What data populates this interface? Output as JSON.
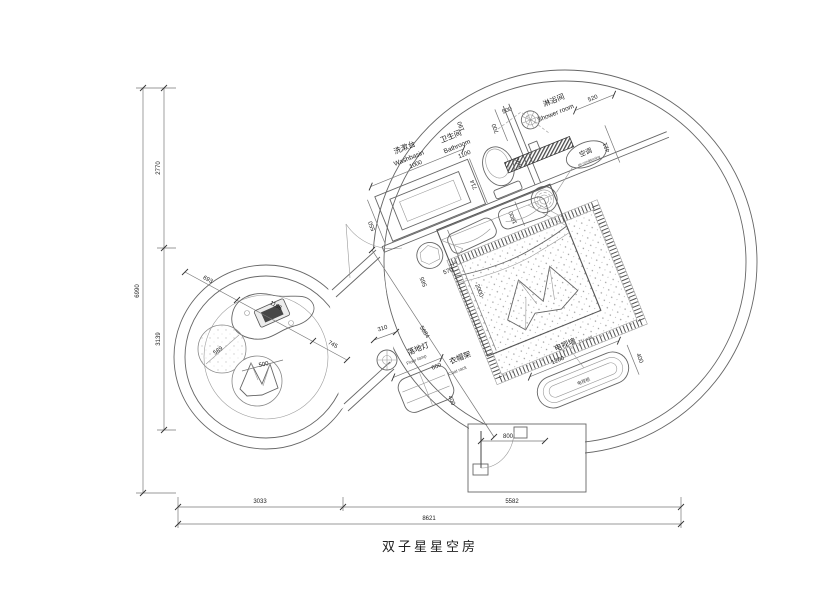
{
  "title": "双子星星空房",
  "dims": {
    "height_total": "6990",
    "height_top": "2770",
    "height_mid": "3139",
    "width_left": "3033",
    "width_right": "5582",
    "width_total": "8621",
    "washbasin": "1000",
    "washbasin_depth": "550",
    "bathroom": "1100",
    "d190": "190",
    "d700": "700",
    "d500": "500",
    "d590": "590",
    "d714": "714",
    "d1800": "1800",
    "d520": "520",
    "d421": "421",
    "d565": "565",
    "d570": "570",
    "d2000": "2000",
    "d5684": "5684",
    "d310": "310",
    "d660": "660",
    "d400_coat": "400",
    "d1200": "1200",
    "d400_tv": "400",
    "d800": "800",
    "d693": "693",
    "d1166": "1166",
    "d745": "745",
    "d589": "589",
    "d500_stool": "500"
  },
  "labels": {
    "washbasin_cn": "洗漱台",
    "washbasin_en": "Washbasin",
    "bathroom_cn": "卫生间",
    "bathroom_en": "Bathroom",
    "shower_cn": "淋浴间",
    "shower_en": "Shower room",
    "ac_cn": "空调",
    "ac_en": "air conditioning",
    "floor_lamp_cn": "落地灯",
    "floor_lamp_en": "Floor lamp",
    "coat_rack_cn": "衣帽架",
    "coat_rack_en": "Coat rack",
    "tv_wall_cn": "电视墙",
    "tv_wall_en": "TV wall",
    "tv_cabinet": "电视柜"
  }
}
